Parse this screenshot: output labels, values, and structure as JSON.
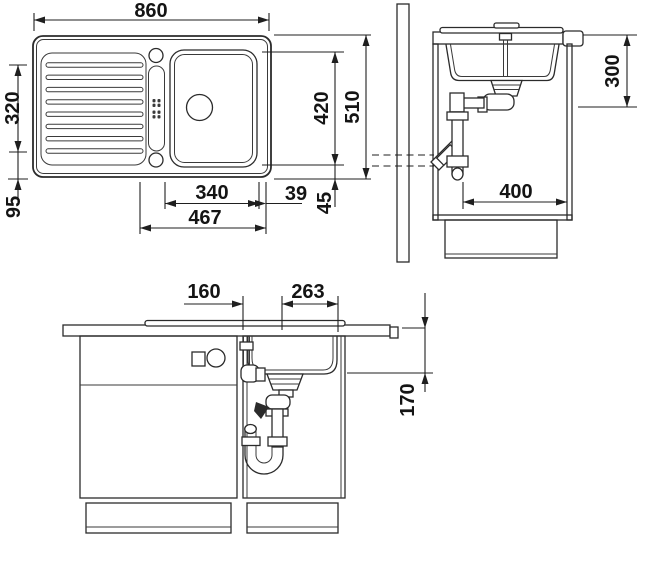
{
  "drawing": {
    "colors": {
      "line": "#2b2b2b",
      "background": "#ffffff",
      "label_text": "#141414"
    },
    "top_view": {
      "overall_width": "860",
      "drainboard_height": "320",
      "drainboard_bottom_offset": "95",
      "bowl_width": "340",
      "bowl_right_gap": "39",
      "bowl_span": "467",
      "bowl_depth": "420",
      "overall_depth": "510",
      "rim_margin": "45"
    },
    "side_view": {
      "worktop_to_drain": "300",
      "cabinet_clearance": "400"
    },
    "front_view": {
      "tap_to_drain": "160",
      "drain_span": "263",
      "worktop_to_drain_bottom": "170"
    }
  }
}
